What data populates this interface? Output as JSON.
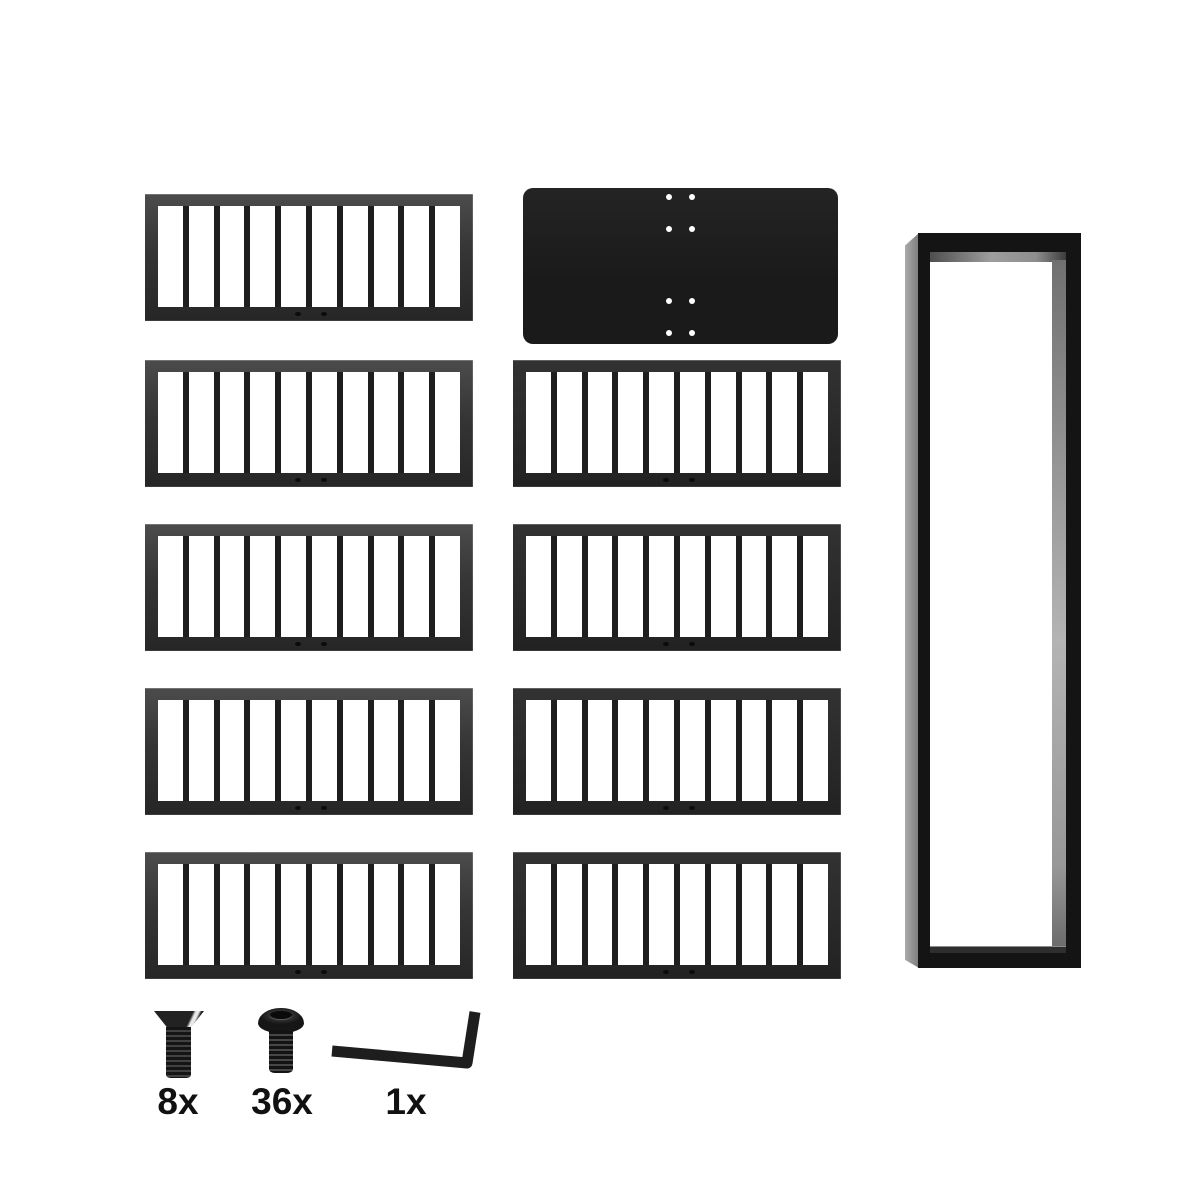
{
  "colors": {
    "background": "#ffffff",
    "panel_frame": "#2f2f2f",
    "panel_bar": "#1e1e1e",
    "plate": "#1a1a1a",
    "leg_front": "#141414",
    "leg_side": "#8f8f8f",
    "hardware": "#1e1e1e",
    "label_text": "#111111"
  },
  "panels": {
    "left_column_count": 5,
    "right_column_count": 4,
    "total_count": 9,
    "slots_per_panel": 10,
    "bottom_holes_per_panel": 2
  },
  "plate": {
    "hole_count": 8,
    "hole_columns": 2,
    "hole_rows": 4
  },
  "leg_frame": {
    "count": 1
  },
  "hardware": [
    {
      "name": "countersunk-screw",
      "label": "8x"
    },
    {
      "name": "button-head-screw",
      "label": "36x"
    },
    {
      "name": "hex-key",
      "label": "1x"
    }
  ]
}
